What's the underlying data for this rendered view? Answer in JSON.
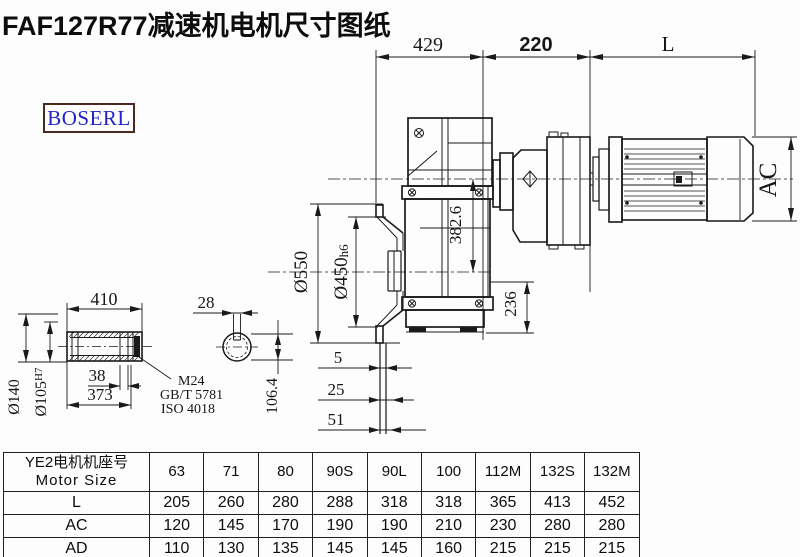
{
  "title": "FAF127R77减速机电机尺寸图纸",
  "logo": {
    "text": "BOSERL",
    "text_color": "#2222cc",
    "border_color": "#4a2a20"
  },
  "dims": {
    "top": {
      "a": "429",
      "b": "220",
      "c": "L"
    },
    "main": {
      "ac": "AC",
      "axis": "382.6",
      "n236": "236",
      "od": "Ø550",
      "sp": "Ø450",
      "sp_tol": "h6",
      "s5": "5",
      "s25": "25",
      "s51": "51"
    },
    "shaft": {
      "len": "410",
      "od": "Ø140",
      "bore": "Ø105",
      "bore_tol": "H7",
      "key": "38",
      "l2": "373",
      "m1": "M24",
      "m2": "GB/T 5781",
      "m3": "ISO 4018"
    },
    "section": {
      "kw": "28",
      "h": "106.4"
    }
  },
  "table": {
    "header_cn": "YE2电机机座号",
    "header_en": "Motor Size",
    "columns": [
      "63",
      "71",
      "80",
      "90S",
      "90L",
      "100",
      "112M",
      "132S",
      "132M"
    ],
    "rows": [
      {
        "label": "L",
        "values": [
          "205",
          "260",
          "280",
          "288",
          "318",
          "318",
          "365",
          "413",
          "452"
        ]
      },
      {
        "label": "AC",
        "values": [
          "120",
          "145",
          "170",
          "190",
          "190",
          "210",
          "230",
          "280",
          "280"
        ]
      },
      {
        "label": "AD",
        "values": [
          "110",
          "130",
          "135",
          "145",
          "145",
          "160",
          "215",
          "215",
          "215"
        ]
      }
    ]
  },
  "colors": {
    "line": "#1a1a1a",
    "background": "#fdfdfd"
  }
}
